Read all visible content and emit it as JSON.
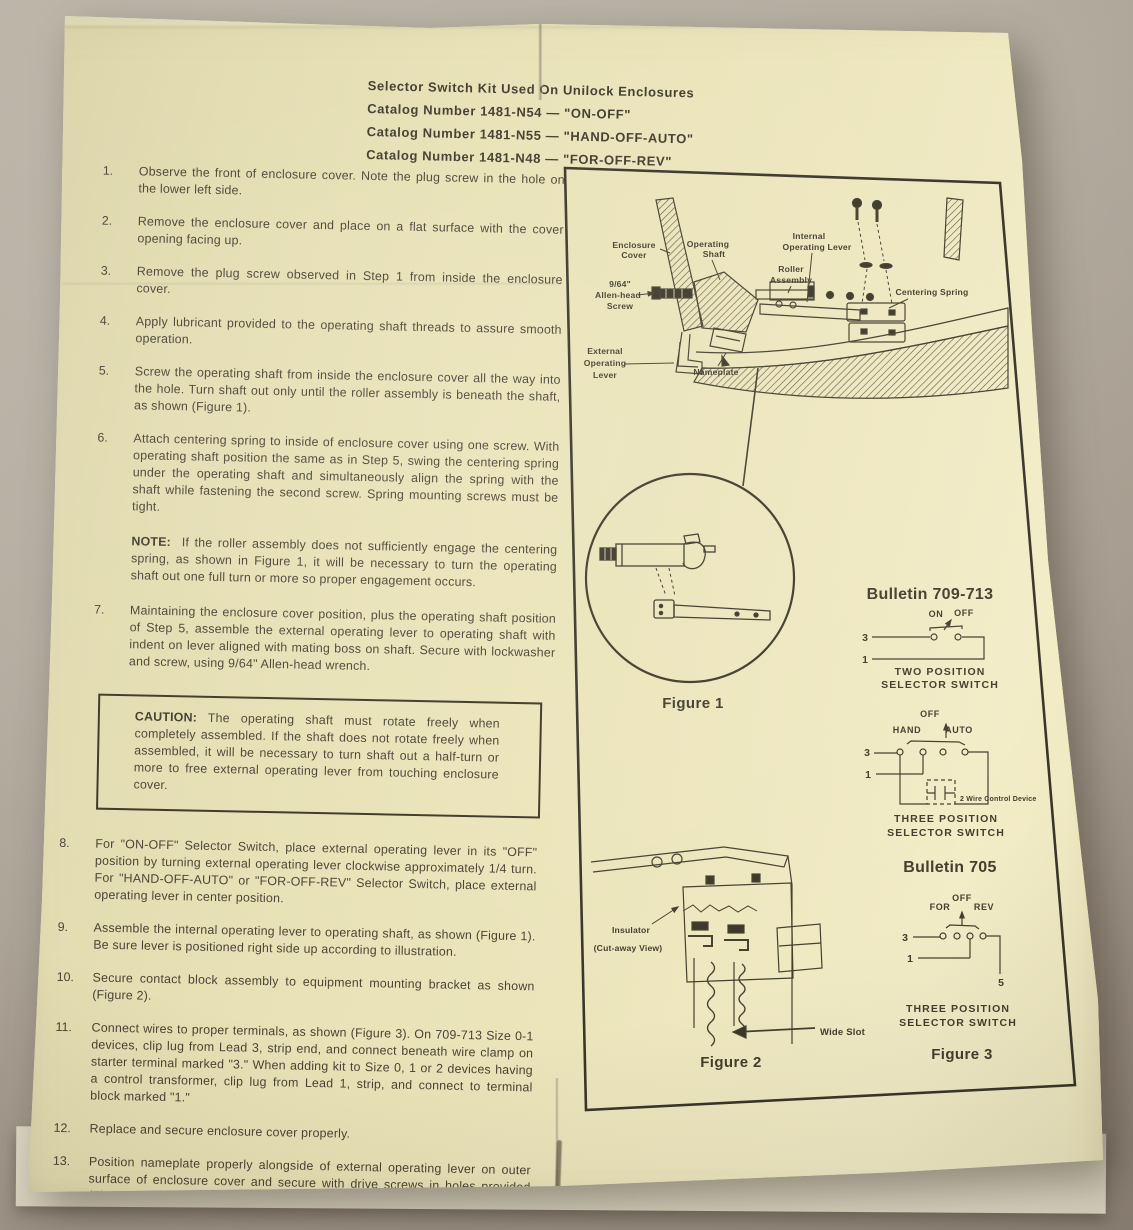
{
  "colors": {
    "paper": "#e9e2b7",
    "background": "#aba294",
    "ink": "#4a4334"
  },
  "header": {
    "title": "Selector Switch Kit Used On Unilock Enclosures",
    "catalog_lines": [
      "Catalog Number 1481-N54 — \"ON-OFF\"",
      "Catalog Number 1481-N55 — \"HAND-OFF-AUTO\"",
      "Catalog Number 1481-N48 — \"FOR-OFF-REV\""
    ]
  },
  "steps": [
    {
      "num": "1.",
      "text": "Observe the front of enclosure cover.  Note the plug screw in the hole on the lower left side."
    },
    {
      "num": "2.",
      "text": "Remove the enclosure cover and place on a flat surface with the cover opening facing up."
    },
    {
      "num": "3.",
      "text": "Remove the plug screw observed in Step 1 from inside the enclosure cover."
    },
    {
      "num": "4.",
      "text": "Apply lubricant provided to the operating shaft threads to assure smooth operation."
    },
    {
      "num": "5.",
      "text": "Screw the operating shaft from inside the enclosure cover all the way into the hole.  Turn shaft out only until the roller assembly is beneath the shaft, as shown (Figure 1)."
    },
    {
      "num": "6.",
      "text": "Attach centering spring to inside of enclosure cover using one screw.  With operating shaft position the same as in Step 5, swing the centering spring under the operating shaft and simultaneously align the spring with the shaft while fastening the second screw.  Spring mounting screws must be tight."
    },
    {
      "num": "7.",
      "text": "Maintaining the enclosure cover position, plus the operating shaft position of Step 5, assemble the external operating lever to operating shaft with indent on lever aligned with mating boss on shaft.  Secure with lockwasher and screw, using 9/64\" Allen-head wrench."
    },
    {
      "num": "8.",
      "text": "For \"ON-OFF\" Selector Switch, place external operating lever in its \"OFF\" position by turning external operating lever clockwise approximately 1/4 turn.  For \"HAND-OFF-AUTO\" or \"FOR-OFF-REV\" Selector Switch, place external operating lever in center position."
    },
    {
      "num": "9.",
      "text": "Assemble the internal operating lever to operating shaft, as shown (Figure 1).  Be sure lever is positioned right side up according to illustration."
    },
    {
      "num": "10.",
      "text": "Secure contact block assembly to equipment mounting bracket as shown (Figure 2)."
    },
    {
      "num": "11.",
      "text": "Connect wires to proper terminals, as shown (Figure 3).  On 709-713 Size 0-1 devices, clip lug from Lead 3, strip end, and connect beneath wire clamp on starter terminal marked \"3.\"  When adding kit to Size 0, 1 or 2 devices having a control transformer, clip lug from Lead 1, strip, and connect to terminal block marked \"1.\""
    },
    {
      "num": "12.",
      "text": "Replace and secure enclosure cover properly."
    },
    {
      "num": "13.",
      "text": "Position nameplate properly alongside of external operating lever on outer surface of enclosure cover and secure with drive screws in holes provided (Figure 1)."
    }
  ],
  "note": {
    "label": "NOTE:",
    "text": "If the roller assembly does not sufficiently engage the centering spring, as shown in Figure 1, it will be necessary to turn the operating shaft out one full turn or more so proper engagement occurs."
  },
  "caution": {
    "label": "CAUTION:",
    "text": "The operating shaft must rotate freely when completely assembled.  If the shaft does not rotate freely when assembled, it will be necessary to turn shaft out a half-turn or more to free external operating lever from touching enclosure cover."
  },
  "figures": {
    "fig1": {
      "labels": {
        "enclosure_cover": [
          "Enclosure",
          "Cover"
        ],
        "operating_shaft": [
          "Operating",
          "Shaft"
        ],
        "internal_operating_lever": [
          "Internal",
          "Operating  Lever"
        ],
        "roller_assembly": [
          "Roller",
          "Assembly"
        ],
        "allen_screw": [
          "9/64\"",
          "Allen-head",
          "Screw"
        ],
        "centering_spring": "Centering Spring",
        "external_operating_lever": [
          "External",
          "Operating",
          "Lever"
        ],
        "nameplate": "Nameplate"
      },
      "caption": "Figure 1"
    },
    "bulletin_709_713": {
      "title": "Bulletin 709-713",
      "two_position": {
        "on": "ON",
        "off": "OFF",
        "t3": "3",
        "t1": "1",
        "caption": [
          "TWO POSITION",
          "SELECTOR SWITCH"
        ]
      },
      "three_position": {
        "off": "OFF",
        "hand": "HAND",
        "auto": "AUTO",
        "t3": "3",
        "t1": "1",
        "device": "2 Wire Control Device",
        "caption": [
          "THREE POSITION",
          "SELECTOR SWITCH"
        ]
      }
    },
    "bulletin_705": {
      "title": "Bulletin 705",
      "three_position": {
        "off": "OFF",
        "for": "FOR",
        "rev": "REV",
        "t3": "3",
        "t1": "1",
        "t5": "5",
        "caption": [
          "THREE POSITION",
          "SELECTOR SWITCH"
        ]
      },
      "caption": "Figure 3"
    },
    "fig2": {
      "insulator": "Insulator",
      "cutaway": "(Cut-away View)",
      "wide_slot": "Wide Slot",
      "caption": "Figure 2"
    }
  }
}
